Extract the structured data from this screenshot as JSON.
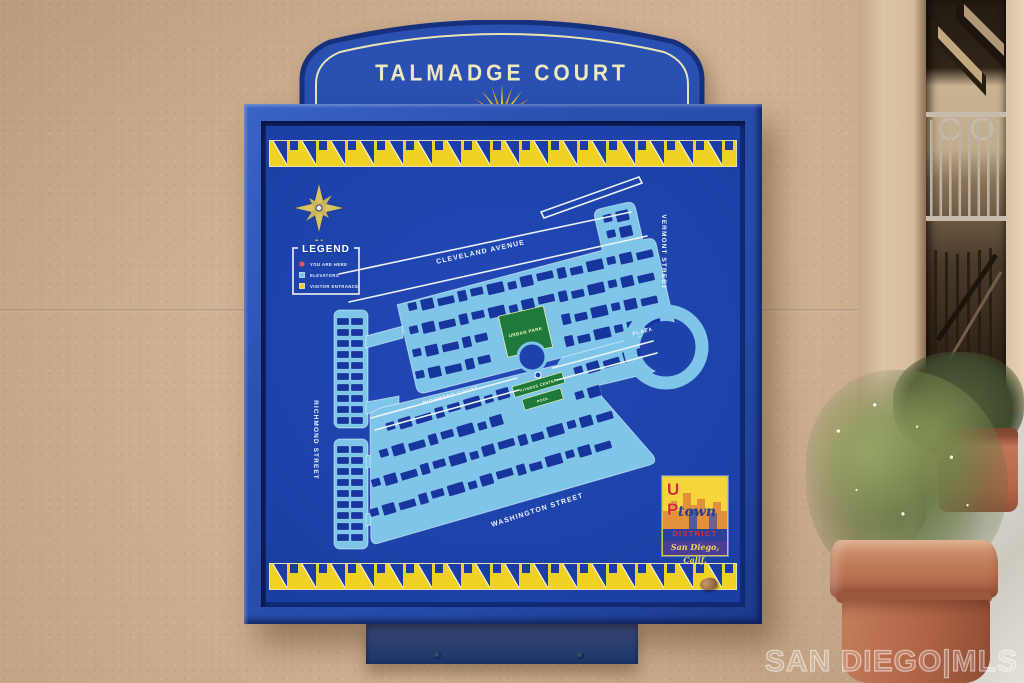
{
  "sign": {
    "title": "TALMADGE COURT",
    "compass_north_label": "N",
    "legend": {
      "title": "LEGEND",
      "items": [
        {
          "label": "YOU ARE HERE",
          "marker": "red-dot"
        },
        {
          "label": "ELEVATORS",
          "marker": "light-blue-square"
        },
        {
          "label": "VISITOR ENTRANCE",
          "marker": "yellow-square"
        }
      ]
    },
    "streets": {
      "cleveland": "CLEVELAND AVENUE",
      "vermont": "VERMONT STREET",
      "plaza": "PLAZA",
      "richmond_court": "RICHMOND COURT",
      "richmond_street": "RICHMOND STREET",
      "washington": "WASHINGTON STREET"
    },
    "places": {
      "urban_park": "URBAN PARK",
      "fitness_center": "FITNESS CENTER",
      "pool": "POOL"
    },
    "logo": {
      "up": "UP",
      "town": "town",
      "district": "DISTRICT",
      "city": "San Diego, Calif."
    },
    "colors": {
      "sign_blue": "#1d42a9",
      "frame_blue": "#2b51b2",
      "walkway_light_blue": "#7ec5e9",
      "building_blue": "#16369e",
      "band_yellow": "#f0d225",
      "band_triangle_blue": "#1c3da5",
      "park_green": "#1e7a3c",
      "cream_lettering": "#ede8c0",
      "wall_tan": "#cfae8d",
      "planter_terracotta": "#b5674a"
    }
  },
  "scene": {
    "watermark": "SAN DIEGO|MLS"
  }
}
